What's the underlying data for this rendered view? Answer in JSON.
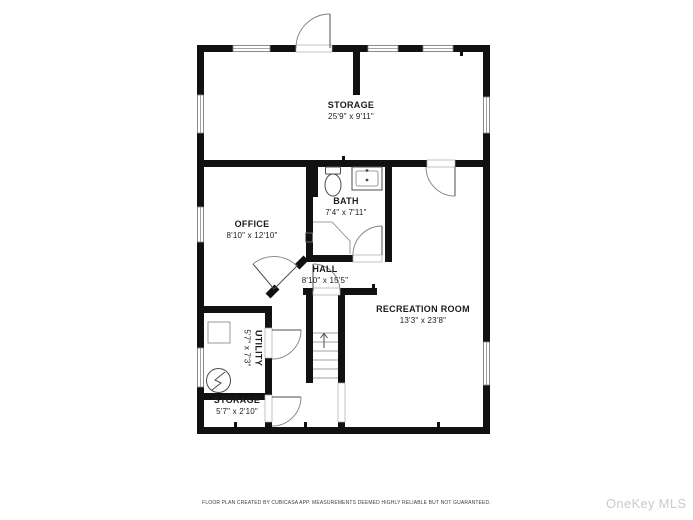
{
  "title": "Basement floor plan",
  "rooms": [
    {
      "id": "storage-top",
      "name": "STORAGE",
      "dims": "25'9\" x 9'11\""
    },
    {
      "id": "office",
      "name": "OFFICE",
      "dims": "8'10\" x 12'10\""
    },
    {
      "id": "bath",
      "name": "BATH",
      "dims": "7'4\" x 7'11\""
    },
    {
      "id": "hall",
      "name": "HALL",
      "dims": "8'10\" x 15'5\""
    },
    {
      "id": "recreation",
      "name": "RECREATION ROOM",
      "dims": "13'3\" x 23'8\""
    },
    {
      "id": "utility",
      "name": "UTILITY",
      "dims": "5'7\" x 7'3\""
    },
    {
      "id": "storage-bottom",
      "name": "STORAGE",
      "dims": "5'7\" x 2'10\""
    }
  ],
  "fixtures": [
    "toilet",
    "sink",
    "shower",
    "stairs-up",
    "electrical-panel",
    "utility-box"
  ],
  "footer": {
    "disclaimer": "FLOOR PLAN CREATED BY CUBICASA APP. MEASUREMENTS DEEMED HIGHLY RELIABLE BUT NOT GUARANTEED."
  },
  "watermark": {
    "text": "OneKey MLS"
  },
  "colors": {
    "wall": "#111111",
    "line": "#4d4d4d",
    "arc": "#808080",
    "window": "#8a8a8a",
    "text": "#1c1c1c",
    "footer_text": "#3c3c3c",
    "watermark": "#cbcbcb",
    "bg": "#ffffff"
  }
}
